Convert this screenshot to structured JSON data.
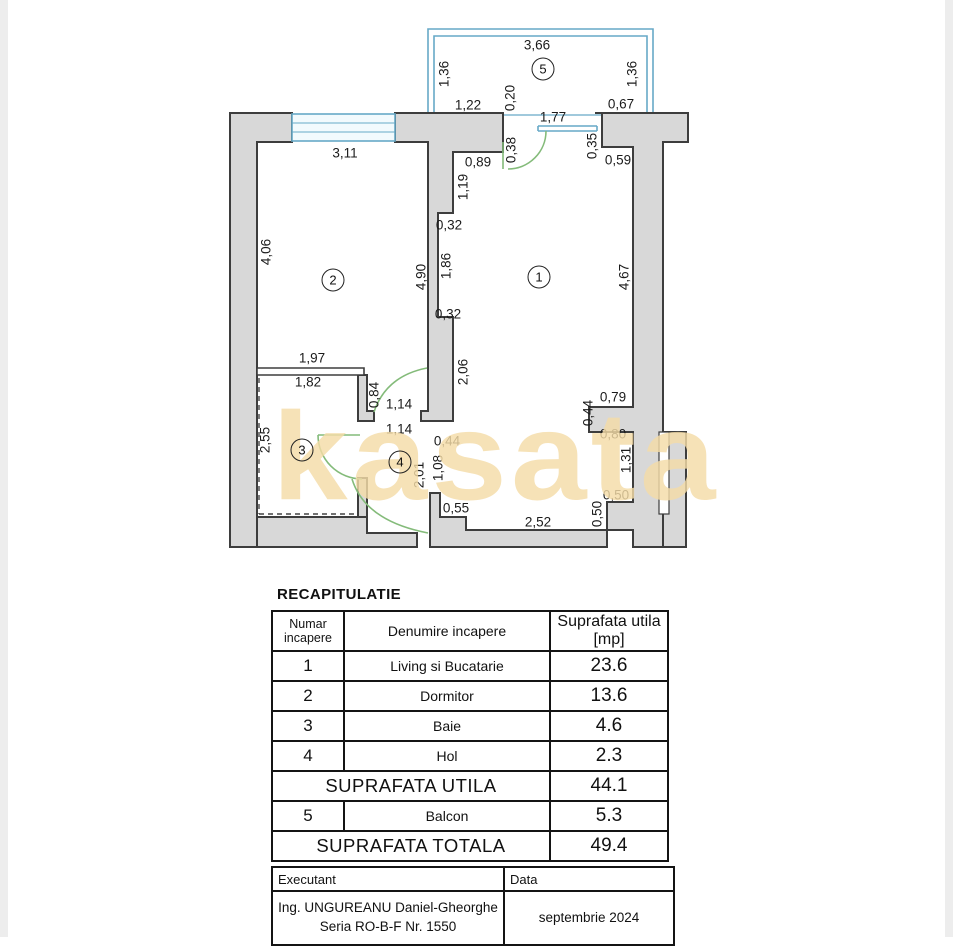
{
  "colors": {
    "wall_fill": "#d8d8d8",
    "wall_outline": "#3d3d3d",
    "window_blue": "#67a9c7",
    "window_fill": "#f2fafd",
    "door_green": "#84bb7a",
    "watermark_tan": "#f4dca7",
    "table_border": "#141414"
  },
  "plan": {
    "watermark": "kasata",
    "rooms": [
      {
        "n": "5",
        "x": 543,
        "y": 69
      },
      {
        "n": "2",
        "x": 333,
        "y": 280
      },
      {
        "n": "1",
        "x": 539,
        "y": 277
      },
      {
        "n": "3",
        "x": 302,
        "y": 450
      },
      {
        "n": "4",
        "x": 400,
        "y": 462
      }
    ],
    "dim_labels": [
      {
        "t": "3,66",
        "x": 537,
        "y": 45,
        "v": 0
      },
      {
        "t": "1,36",
        "x": 444,
        "y": 74,
        "v": 1
      },
      {
        "t": "1,36",
        "x": 632,
        "y": 74,
        "v": 1
      },
      {
        "t": "1,22",
        "x": 468,
        "y": 105,
        "v": 0
      },
      {
        "t": "0,20",
        "x": 510,
        "y": 98,
        "v": 1
      },
      {
        "t": "1,77",
        "x": 553,
        "y": 117,
        "v": 0
      },
      {
        "t": "0,67",
        "x": 621,
        "y": 104,
        "v": 0
      },
      {
        "t": "0,38",
        "x": 511,
        "y": 150,
        "v": 1
      },
      {
        "t": "0,35",
        "x": 592,
        "y": 146,
        "v": 1
      },
      {
        "t": "0,59",
        "x": 618,
        "y": 160,
        "v": 0
      },
      {
        "t": "0,89",
        "x": 478,
        "y": 162,
        "v": 0
      },
      {
        "t": "1,19",
        "x": 463,
        "y": 187,
        "v": 1
      },
      {
        "t": "3,11",
        "x": 345,
        "y": 153,
        "v": 0
      },
      {
        "t": "4,06",
        "x": 266,
        "y": 252,
        "v": 1
      },
      {
        "t": "4,90",
        "x": 421,
        "y": 277,
        "v": 1
      },
      {
        "t": "0,32",
        "x": 449,
        "y": 225,
        "v": 0
      },
      {
        "t": "1,86",
        "x": 446,
        "y": 266,
        "v": 1
      },
      {
        "t": "0,32",
        "x": 448,
        "y": 314,
        "v": 0
      },
      {
        "t": "4,67",
        "x": 624,
        "y": 277,
        "v": 1
      },
      {
        "t": "2,06",
        "x": 463,
        "y": 372,
        "v": 1
      },
      {
        "t": "1,97",
        "x": 312,
        "y": 358,
        "v": 0
      },
      {
        "t": "1,82",
        "x": 308,
        "y": 382,
        "v": 0
      },
      {
        "t": "0,84",
        "x": 374,
        "y": 395,
        "v": 1
      },
      {
        "t": "1,14",
        "x": 399,
        "y": 404,
        "v": 0
      },
      {
        "t": "1,14",
        "x": 399,
        "y": 429,
        "v": 0
      },
      {
        "t": "0,44",
        "x": 447,
        "y": 441,
        "v": 0
      },
      {
        "t": "2,55",
        "x": 265,
        "y": 440,
        "v": 1
      },
      {
        "t": "2,01",
        "x": 419,
        "y": 475,
        "v": 1
      },
      {
        "t": "1,08",
        "x": 438,
        "y": 468,
        "v": 1
      },
      {
        "t": "0,55",
        "x": 456,
        "y": 508,
        "v": 0
      },
      {
        "t": "2,52",
        "x": 538,
        "y": 522,
        "v": 0
      },
      {
        "t": "0,79",
        "x": 613,
        "y": 397,
        "v": 0
      },
      {
        "t": "0,44",
        "x": 588,
        "y": 413,
        "v": 1
      },
      {
        "t": "0,80",
        "x": 613,
        "y": 434,
        "v": 0
      },
      {
        "t": "1,31",
        "x": 626,
        "y": 460,
        "v": 1
      },
      {
        "t": "0,50",
        "x": 616,
        "y": 495,
        "v": 0
      },
      {
        "t": "0,50",
        "x": 597,
        "y": 514,
        "v": 1
      }
    ]
  },
  "recap": {
    "title": "RECAPITULATIE",
    "headers": {
      "c1": "Numar incapere",
      "c2": "Denumire incapere",
      "c3": "Suprafata utila [mp]"
    },
    "rows": [
      {
        "num": "1",
        "name": "Living si Bucatarie",
        "area": "23.6"
      },
      {
        "num": "2",
        "name": "Dormitor",
        "area": "13.6"
      },
      {
        "num": "3",
        "name": "Baie",
        "area": "4.6"
      },
      {
        "num": "4",
        "name": "Hol",
        "area": "2.3"
      }
    ],
    "utila": {
      "label": "SUPRAFATA UTILA",
      "value": "44.1"
    },
    "balcon": {
      "num": "5",
      "name": "Balcon",
      "area": "5.3"
    },
    "totala": {
      "label": "SUPRAFATA TOTALA",
      "value": "49.4"
    },
    "footer": {
      "executant_label": "Executant",
      "data_label": "Data",
      "executant_line1": "Ing. UNGUREANU Daniel-Gheorghe",
      "executant_line2": "Seria RO-B-F Nr. 1550",
      "date_value": "septembrie 2024"
    }
  }
}
